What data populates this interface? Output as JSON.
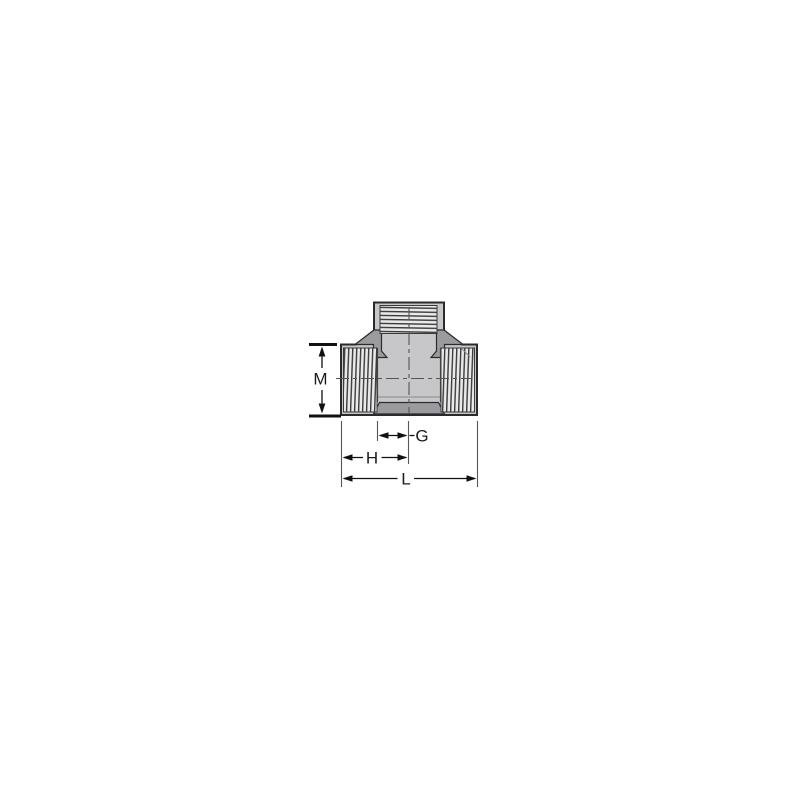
{
  "page": {
    "background": "#ffffff"
  },
  "drawing": {
    "type": "technical-dimension-diagram",
    "subject": "threaded tee pipe fitting, front elevation with section detail",
    "labels": {
      "m": "M",
      "g": "G",
      "h": "H",
      "l": "L"
    },
    "colors": {
      "page_background": "#ffffff",
      "body_fill": "#c7c7c9",
      "fillet_fill": "#9b9b9f",
      "outline": "#2b2b2b",
      "inner_line": "#4a4a4a",
      "faint_line": "#8a8a8a",
      "thread_bg": "#e9e9e9",
      "thread_line": "#3a3a3a",
      "centerline": "#555555",
      "dimension_line": "#111111",
      "extension_line": "#555555",
      "label_color": "#1a1a1a"
    }
  }
}
